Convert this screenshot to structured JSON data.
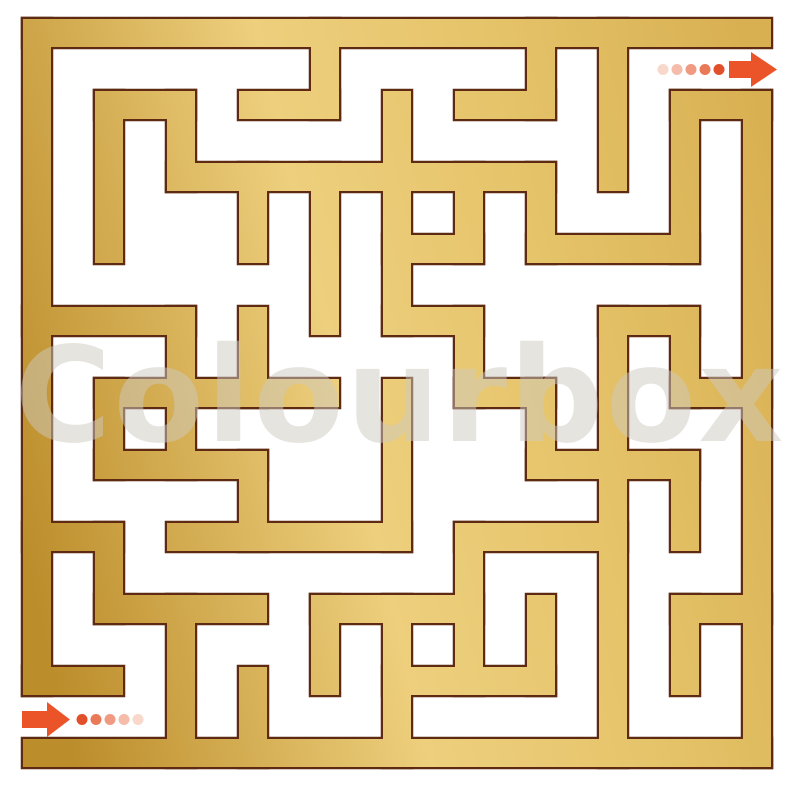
{
  "canvas": {
    "width": 800,
    "height": 792,
    "background": "#FFFFFF"
  },
  "maze": {
    "grid": {
      "origin_x": 37,
      "origin_y": 33,
      "pitch": 72,
      "wall_thickness": 28,
      "cols": 10,
      "rows": 10
    },
    "outline_color": "#5E2B12",
    "outline_width": 4.5,
    "gold_gradient": {
      "direction": {
        "x1": 0,
        "y1": 450,
        "x2": 800,
        "y2": 260
      },
      "stops": [
        {
          "offset": "0%",
          "color": "#BC8D2B"
        },
        {
          "offset": "42%",
          "color": "#EDCF7D"
        },
        {
          "offset": "70%",
          "color": "#E5C369"
        },
        {
          "offset": "100%",
          "color": "#D8B052"
        }
      ]
    },
    "h_segments": [
      [
        0,
        0,
        10
      ],
      [
        1,
        1,
        2
      ],
      [
        1,
        3,
        4
      ],
      [
        1,
        6,
        7
      ],
      [
        1,
        9,
        10
      ],
      [
        2,
        2,
        7
      ],
      [
        3,
        5,
        6
      ],
      [
        3,
        7,
        9
      ],
      [
        4,
        0,
        2
      ],
      [
        4,
        5,
        6
      ],
      [
        4,
        8,
        9
      ],
      [
        5,
        1,
        4
      ],
      [
        5,
        6,
        7
      ],
      [
        5,
        9,
        10
      ],
      [
        6,
        1,
        3
      ],
      [
        6,
        7,
        9
      ],
      [
        7,
        0,
        1
      ],
      [
        7,
        2,
        5
      ],
      [
        7,
        6,
        8
      ],
      [
        8,
        1,
        3
      ],
      [
        8,
        4,
        6
      ],
      [
        8,
        9,
        10
      ],
      [
        9,
        0,
        1
      ],
      [
        9,
        5,
        7
      ],
      [
        10,
        0,
        10
      ]
    ],
    "v_segments": [
      [
        0,
        0,
        9
      ],
      [
        1,
        1,
        3
      ],
      [
        1,
        5,
        6
      ],
      [
        1,
        7,
        8
      ],
      [
        2,
        1,
        2
      ],
      [
        2,
        4,
        6
      ],
      [
        2,
        8,
        10
      ],
      [
        3,
        2,
        3
      ],
      [
        3,
        4,
        5
      ],
      [
        3,
        6,
        7
      ],
      [
        3,
        9,
        10
      ],
      [
        4,
        0,
        1
      ],
      [
        4,
        2,
        4
      ],
      [
        4,
        8,
        9
      ],
      [
        5,
        1,
        4
      ],
      [
        5,
        5,
        7
      ],
      [
        5,
        8,
        10
      ],
      [
        6,
        2,
        3
      ],
      [
        6,
        4,
        5
      ],
      [
        6,
        7,
        9
      ],
      [
        7,
        0,
        1
      ],
      [
        7,
        2,
        3
      ],
      [
        7,
        5,
        6
      ],
      [
        7,
        8,
        9
      ],
      [
        8,
        0,
        2
      ],
      [
        8,
        4,
        10
      ],
      [
        9,
        1,
        3
      ],
      [
        9,
        4,
        5
      ],
      [
        9,
        6,
        7
      ],
      [
        9,
        8,
        9
      ],
      [
        10,
        1,
        10
      ]
    ],
    "entrance": {
      "side": "left",
      "gap_y_from": 695,
      "gap_y_to": 739
    },
    "exit": {
      "side": "right",
      "gap_y_from": 48,
      "gap_y_to": 91
    }
  },
  "entry_marker": {
    "arrow_color": "#EB5428",
    "arrow_points": [
      [
        22,
        711
      ],
      [
        47,
        711
      ],
      [
        47,
        702
      ],
      [
        70,
        719.5
      ],
      [
        47,
        737
      ],
      [
        47,
        728
      ],
      [
        22,
        728
      ]
    ],
    "dots": {
      "cy": 719.5,
      "r": 5.5,
      "cx": [
        82,
        96,
        110,
        124,
        138
      ],
      "colors": [
        "#E1502B",
        "#EA7958",
        "#F09B81",
        "#F5BCAA",
        "#F9D8CC"
      ]
    }
  },
  "exit_marker": {
    "arrow_color": "#EB5428",
    "arrow_points": [
      [
        729,
        61
      ],
      [
        751,
        61
      ],
      [
        751,
        52
      ],
      [
        777,
        69.5
      ],
      [
        751,
        87
      ],
      [
        751,
        78
      ],
      [
        729,
        78
      ]
    ],
    "dots": {
      "cy": 69.5,
      "r": 5.5,
      "cx": [
        663,
        677,
        691,
        705,
        719
      ],
      "colors": [
        "#F9D8CC",
        "#F5BCAA",
        "#F09B81",
        "#EA7958",
        "#E1502B"
      ]
    }
  },
  "watermark": {
    "text": "Colourbox",
    "color": "rgba(206,202,192,0.5)",
    "font_size": 132
  }
}
